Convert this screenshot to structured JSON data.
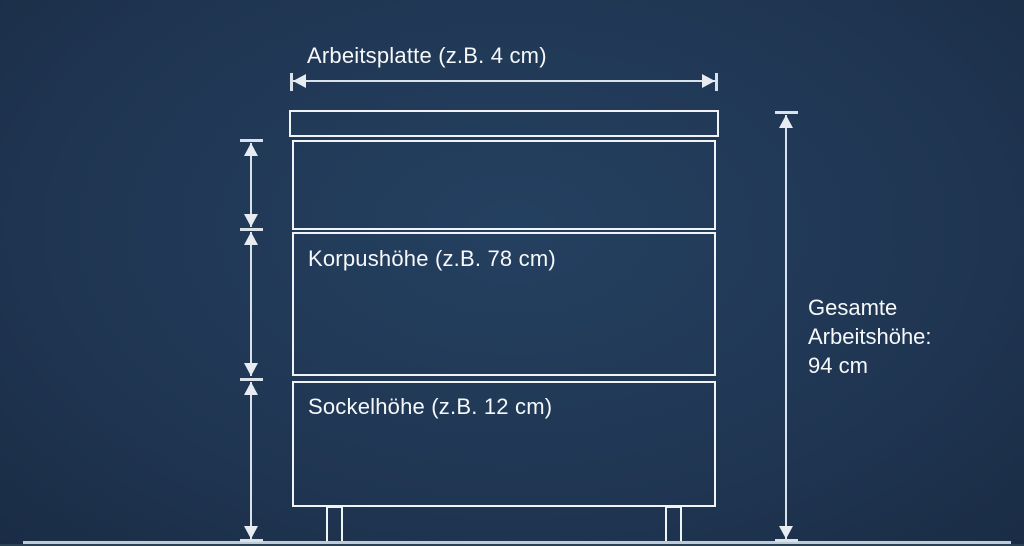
{
  "diagram": {
    "type": "kitchen-cabinet-height-dimension-diagram",
    "labels": {
      "worktop": "Arbeitsplatte (z.B. 4 cm)",
      "korpus": "Korpushöhe (z.B. 78 cm)",
      "sockel": "Sockelhöhe (z.B. 12 cm)",
      "total_line1": "Gesamte",
      "total_line2": "Arbeitshöhe:",
      "total_line3": "94 cm"
    },
    "measurements": {
      "arbeitsplatte_cm": 4,
      "korpushoehe_cm": 78,
      "sockelhoehe_cm": 12,
      "gesamte_arbeitshoehe_cm": 94
    },
    "colors": {
      "background": "#203754",
      "cabinet_line": "#f0f4f7",
      "dimension_line": "#d9e1e9",
      "text": "#f6f8fa",
      "floor_line": "#bfccd8"
    }
  }
}
